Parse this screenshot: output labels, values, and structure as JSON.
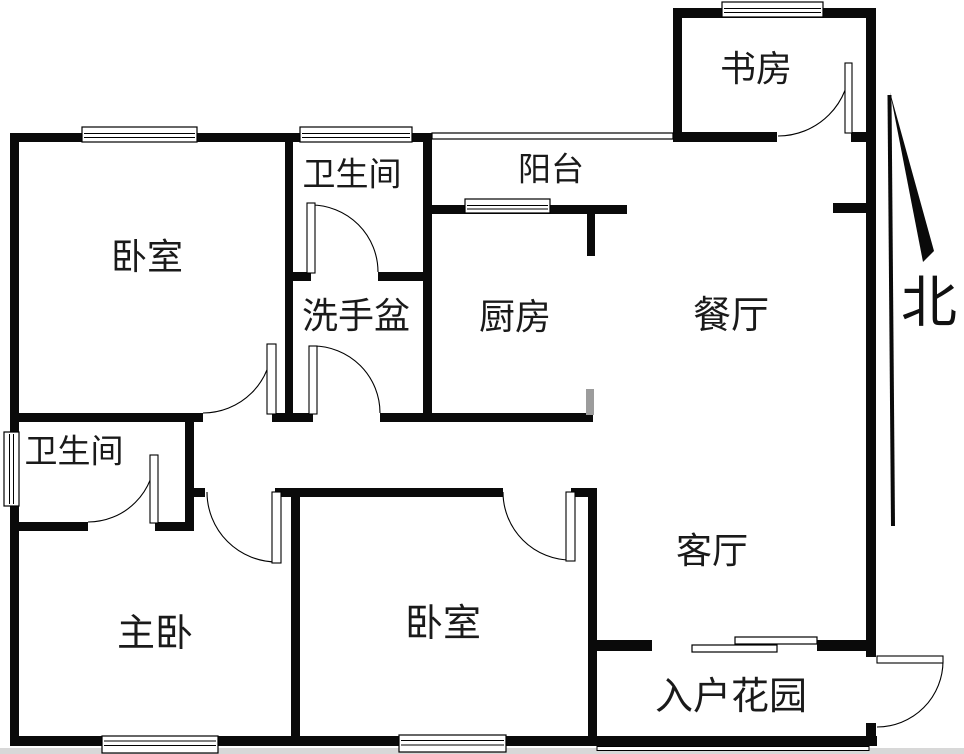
{
  "labels": {
    "bedroom_north": "卧室",
    "bathroom_north": "卫生间",
    "washbasin": "洗手盆",
    "balcony": "阳台",
    "kitchen": "厨房",
    "dining": "餐厅",
    "study": "书房",
    "bathroom_west": "卫生间",
    "master_bedroom": "主卧",
    "bedroom_south": "卧室",
    "living": "客厅",
    "entry_garden": "入户花园"
  },
  "compass": {
    "north": "北"
  },
  "colors": {
    "wall": "#0a0a0a",
    "gray_wall": "#9c9c9c",
    "line": "#000000",
    "background": "#ffffff",
    "footer_strip": "#d8d8d8",
    "text": "#1a1a1a"
  }
}
